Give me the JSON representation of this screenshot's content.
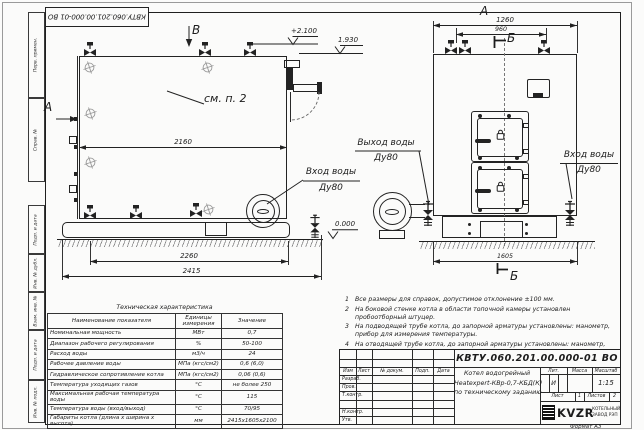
{
  "doc": {
    "number": "КВТУ.060.201.00.000-01 ВО",
    "format": "Формат А3"
  },
  "frame_left": {
    "items": [
      "Перв. примен.",
      "Справ. №",
      "Подп. и дата",
      "Инв. № дубл.",
      "Взам. инв. №",
      "Подп. и дата",
      "Инв. № подл."
    ]
  },
  "views": {
    "label_a": "А",
    "label_b": "Б",
    "label_v": "В",
    "note_ref": "см. п. 2"
  },
  "levels": {
    "top": "+2.100",
    "mid": "1.930",
    "zero": "0.000"
  },
  "dims": {
    "d2160": "2160",
    "d2260": "2260",
    "d2415": "2415",
    "d1260": "1260",
    "d960": "960",
    "d1605": "1605"
  },
  "labels": {
    "outlet_line1": "Выход воды",
    "outlet_line2": "Ду80",
    "inlet_left_line1": "Вход воды",
    "inlet_left_line2": "Ду80",
    "inlet_right_line1": "Вход воды",
    "inlet_right_line2": "Ду80"
  },
  "tech_table": {
    "title": "Техническая характеристика",
    "headers": [
      "Наименование показателя",
      "Единицы измерения",
      "Значение"
    ],
    "rows": [
      {
        "name": "Номинальная мощность",
        "unit": "МВт",
        "value": "0,7"
      },
      {
        "name": "Диапазон рабочего регулирования",
        "unit": "%",
        "value": "50-100"
      },
      {
        "name": "Расход воды",
        "unit": "м3/ч",
        "value": "24"
      },
      {
        "name": "Рабочее давление воды",
        "unit": "МПа (кгс/см2)",
        "value": "0,6 (6,0)"
      },
      {
        "name": "Гидравлическое сопротивление котла",
        "unit": "МПа (кгс/см2)",
        "value": "0,06 (0,6)"
      },
      {
        "name": "Температура уходящих газов",
        "unit": "°С",
        "value": "не более 250"
      },
      {
        "name": "Максимальная рабочая температура воды",
        "unit": "°С",
        "value": "115"
      },
      {
        "name": "Температура воды (вход/выход)",
        "unit": "°С",
        "value": "70/95"
      },
      {
        "name": "Габариты котла (длина х ширина х высота)",
        "unit": "мм",
        "value": "2415х1605х2100"
      }
    ]
  },
  "notes": {
    "items": [
      {
        "num": "1",
        "text": "Все размеры для справок, допустимое отклонение ±100 мм."
      },
      {
        "num": "2",
        "text": "На боковой стенке котла в области топочной камеры установлен пробоотборный штуцер."
      },
      {
        "num": "3",
        "text": "На подводящей трубе котла, до запорной арматуры установлены: манометр, прибор для измерения температуры."
      },
      {
        "num": "4",
        "text": "На отводящей трубе котла, до запорной арматуры установлены: манометр, прибор для измерения температуры, предохранительный клапан Ду не менее 50 мм и обвод с обратным клапаном Ду не менее 50 мм."
      }
    ]
  },
  "title_block": {
    "columns": [
      "Изм",
      "Лист",
      "№ докум.",
      "Подп.",
      "Дата"
    ],
    "rows": [
      "Разраб.",
      "Пров.",
      "Т.контр.",
      "Н.контр.",
      "Утв."
    ],
    "name_line1": "Котел водогрейный",
    "name_line2": "Heatexpert-КВр-0,7-КБД(К)",
    "name_line3": "по техническому заданию",
    "lit_label": "Лит.",
    "lit_value": "И",
    "mass_label": "Масса",
    "scale_label": "Масштаб",
    "scale_value": "1:15",
    "sheet_label": "Лист",
    "sheet_value": "1",
    "sheets_label": "Листов",
    "sheets_value": "2",
    "logo_text": "KVZR",
    "org_line1": "КОТЕЛЬНЫЙ",
    "org_line2": "ЗАВОД РЭП"
  }
}
